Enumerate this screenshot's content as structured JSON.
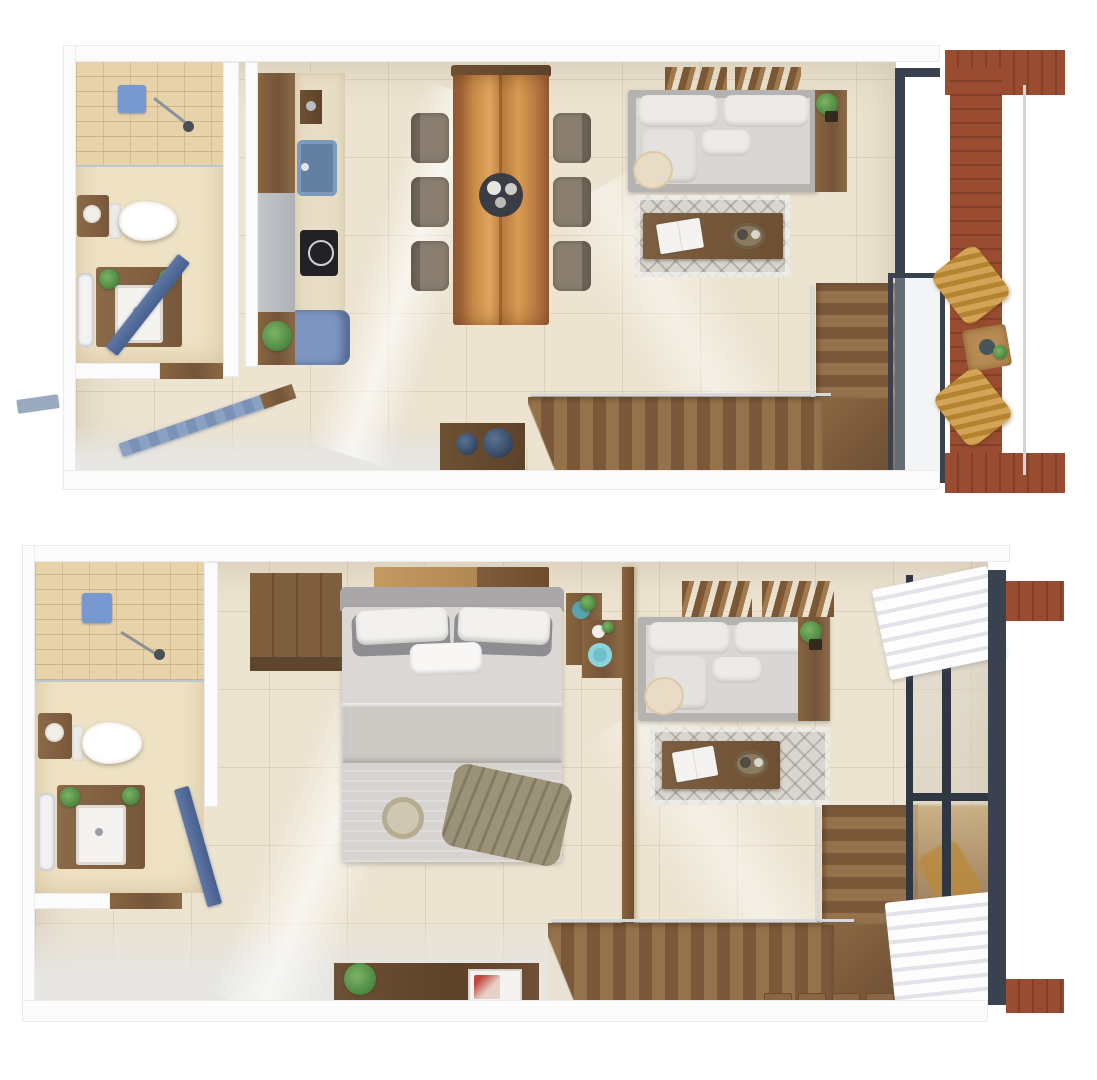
{
  "document": {
    "type": "architectural-floor-plan-render",
    "description": "Two photorealistic top-down 3D floor plan renders of a two-level loft apartment, stacked vertically on a white background. No text labels are rendered in the image.",
    "palette": {
      "background": "#ffffff",
      "walls": "#fbfbfc",
      "tile_floor": "#ece3d0",
      "bathroom_floor": "#efe2c4",
      "shower_tile": "#e7d2aa",
      "stair_wood": "#8a6743",
      "furniture_wood": "#7a5a3a",
      "dining_table_wood": "#c98c47",
      "deck_redwood": "#9a4c31",
      "accent_blue": "#7b97c4",
      "navy_decor": "#33465f",
      "glass_frame_dark": "#39424e",
      "sofa_gray": "#b5b3b1",
      "cushion_white": "#edebe8",
      "wicker_mustard": "#c7984d",
      "plant_green": "#4f8a44",
      "teal_decor": "#5fb3c0",
      "olive_throw": "#9b9278"
    }
  },
  "floors": [
    {
      "label": "Level 1 plan - open living area",
      "rooms": [
        {
          "name": "bathroom",
          "furniture": [
            "walk-in shower",
            "shower head",
            "toilet",
            "side basin table",
            "vanity with sink",
            "towel rail",
            "blue door"
          ]
        },
        {
          "name": "kitchen",
          "furniture": [
            "tall wood cabinet",
            "gray counter",
            "blue sink",
            "black cooktop",
            "blue base cabinet",
            "potted plant"
          ]
        },
        {
          "name": "dining room",
          "furniture": [
            "live-edge wood table",
            "bench",
            "six upholstered chairs",
            "centerpiece tray"
          ]
        },
        {
          "name": "living room",
          "furniture": [
            "gray sectional sofa with chaise",
            "round cream pillow",
            "wood console with plant",
            "patterned rug",
            "wood coffee table",
            "open book",
            "decor tray",
            "wood ceiling slats"
          ]
        },
        {
          "name": "stairs",
          "furniture": [
            "L-shaped wood staircase",
            "chrome handrail",
            "under-stair console",
            "two navy bowls"
          ]
        },
        {
          "name": "balcony",
          "furniture": [
            "redwood deck",
            "two wicker lounge chairs",
            "small wood side table with plant",
            "glass wall with dark frame",
            "railing"
          ]
        },
        {
          "name": "entry",
          "furniture": [
            "open louvered blue door"
          ]
        }
      ]
    },
    {
      "label": "Level 2 plan - bedroom suite",
      "rooms": [
        {
          "name": "bathroom",
          "furniture": [
            "walk-in shower",
            "shower head",
            "toilet",
            "side basin table",
            "vanity with sink",
            "towel rail",
            "blue door"
          ]
        },
        {
          "name": "bedroom",
          "furniture": [
            "wardrobe",
            "wood headboard slats",
            "double bed",
            "two white pillows",
            "two gray pillows",
            "white accent pillow",
            "gray sheet band",
            "olive throw blanket",
            "round woven tray",
            "nightstand with teal plant",
            "side table with teal plate and vase",
            "wood-framed glass divider"
          ]
        },
        {
          "name": "sitting area",
          "furniture": [
            "gray sectional sofa with chaise",
            "round cream pillow",
            "wood console with plant",
            "patterned rug",
            "wood coffee table",
            "open book",
            "decor tray",
            "wood ceiling slats"
          ]
        },
        {
          "name": "stairs",
          "furniture": [
            "L-shaped wood staircase",
            "chrome handrail",
            "wood floor mats"
          ]
        },
        {
          "name": "window wall",
          "furniture": [
            "glass wall with dark mullions",
            "two white roman curtains",
            "exterior deck ledges"
          ]
        },
        {
          "name": "media wall",
          "furniture": [
            "wood TV console",
            "potted plant",
            "television"
          ]
        }
      ]
    }
  ]
}
